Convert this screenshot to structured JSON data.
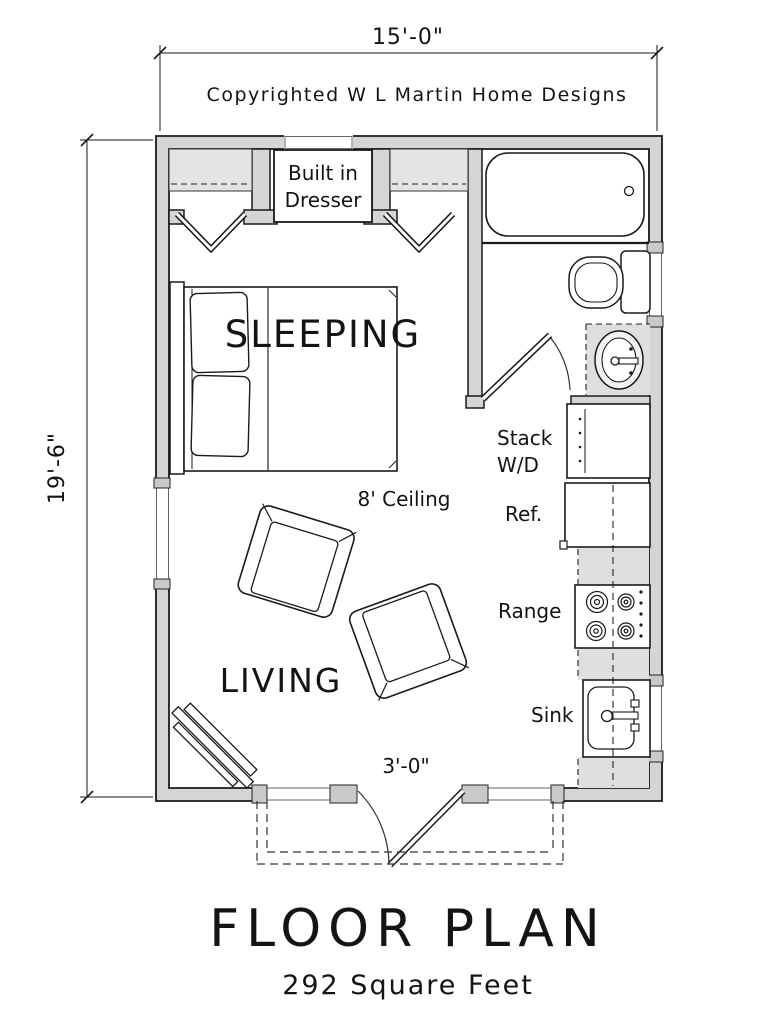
{
  "title": {
    "main": "FLOOR PLAN",
    "sub": "292 Square Feet"
  },
  "copyright": "Copyrighted W L Martin Home Designs",
  "dimensions": {
    "overall_width": "15'-0\"",
    "overall_depth": "19'-6\"",
    "entry_door": "3'-0\""
  },
  "rooms": {
    "sleeping": "SLEEPING",
    "living": "LIVING",
    "ceiling_note": "8' Ceiling"
  },
  "closet": {
    "dresser_line1": "Built in",
    "dresser_line2": "Dresser"
  },
  "kitchen": {
    "stack_line1": "Stack",
    "stack_line2": "W/D",
    "ref": "Ref.",
    "range": "Range",
    "sink": "Sink"
  },
  "colors": {
    "line": "#1a1a1a",
    "wall_fill": "#d5d5d5",
    "shelf_fill": "#e4e4e4",
    "counter_fill": "#dfdfdf",
    "post_fill": "#c9c9c9",
    "paper": "#ffffff"
  }
}
